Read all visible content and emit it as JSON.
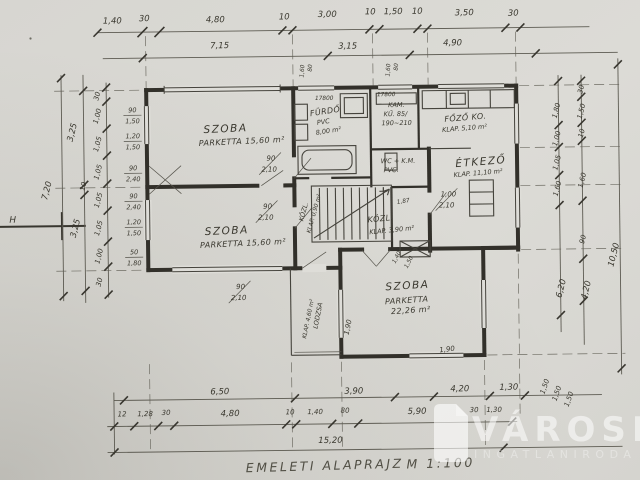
{
  "meta": {
    "sheet_title": "EMELETI ALAPRAJZ",
    "scale": "M 1:100",
    "section_marker": "H"
  },
  "watermark": {
    "brand": "VÁROSI",
    "subtitle": "INGATLANIRODA"
  },
  "rooms": {
    "szoba1": {
      "name": "SZOBA",
      "detail": "PARKETTA 15,60 m²"
    },
    "szoba2": {
      "name": "SZOBA",
      "detail": "PARKETTA 15,60 m²"
    },
    "szoba3": {
      "name": "SZOBA",
      "line2": "PARKETTA",
      "line3": "22,26 m²"
    },
    "furdo": {
      "name": "FÜRDŐ",
      "line2": "PVC",
      "line3": "8,00 m²"
    },
    "kamra": {
      "name": "KAM.",
      "line2": "KŰ. 85/",
      "line3": "190~210"
    },
    "fozo": {
      "name": "FŐZŐ KO.",
      "detail": "KLAP. 5,10 m²"
    },
    "etkezo": {
      "name": "ÉTKEZŐ",
      "detail": "KLAP. 11,10 m²"
    },
    "wc": {
      "name": "WC + K.M.",
      "line2": "PVC."
    },
    "kozl_kis": {
      "name": "KÖZL.",
      "detail": "KLAP. 0,90 m²"
    },
    "kozl": {
      "name": "KÖZL.",
      "detail": "KLAP. 3,90 m²"
    },
    "lodzsa": {
      "name": "LODZSA",
      "detail": "KLAP. 4,60 m²"
    }
  },
  "dims": {
    "top_row1": [
      "1,40",
      "30",
      "4,80",
      "10",
      "3,00",
      "10",
      "1,50",
      "10",
      "3,50",
      "30"
    ],
    "top_row2": [
      "7,15",
      "3,15",
      "4,90"
    ],
    "bottom_row1": [
      "6,50",
      "3,90",
      "4,20",
      "1,30"
    ],
    "bottom_row1_small": [
      "30",
      "1,30"
    ],
    "bottom_row2": [
      "12",
      "1,28",
      "30",
      "4,80",
      "10",
      "1,40",
      "80",
      "5,90"
    ],
    "bottom_total": "15,20",
    "left_total": "7,20",
    "left_mid": [
      "3,25",
      "10",
      "3,25"
    ],
    "left_segments": [
      "30",
      "1,00",
      "1,05",
      "1,05",
      "1,05",
      "1,05",
      "1,00",
      "30"
    ],
    "left_window_specs": [
      [
        "90",
        "1,50"
      ],
      [
        "1,20",
        "1,50"
      ],
      [
        "90",
        "2,40"
      ],
      [
        "90",
        "2,40"
      ],
      [
        "1,20",
        "1,50"
      ],
      [
        "50",
        "1,80"
      ]
    ],
    "right_outer": [
      "1,80",
      "1,00",
      "1,05",
      "1,60",
      "6,20"
    ],
    "right_inner": [
      "30",
      "1,50",
      "10",
      "1,60",
      "90",
      "4,20"
    ],
    "right_total": "10,50",
    "right_small": [
      "1,50",
      "1,50",
      "1,50"
    ],
    "door_specs": [
      [
        "90",
        "2,10"
      ],
      [
        "90",
        "2,10"
      ],
      [
        "90",
        "2,10"
      ],
      [
        "1,00",
        "2,10"
      ]
    ],
    "stair_specs": [
      "1,87",
      "1,40",
      "1,50"
    ],
    "window_heads": [
      "17800",
      "17800"
    ],
    "top_window_specs": [
      [
        "1,60",
        "80"
      ],
      [
        "1,60",
        "80"
      ]
    ],
    "misc": [
      "1,90",
      "1,90"
    ]
  }
}
